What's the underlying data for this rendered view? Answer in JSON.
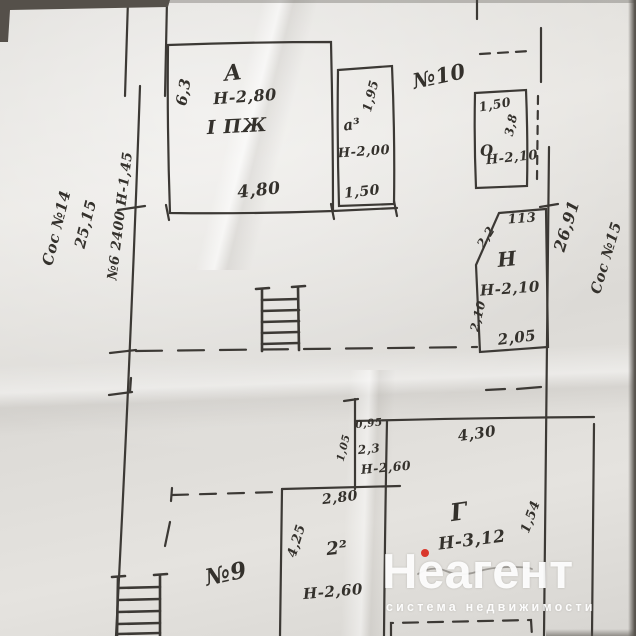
{
  "colors": {
    "paper": "#e2e0dc",
    "ink": "#3c3935",
    "watermark_accent": "#d9372b"
  },
  "plan": {
    "left_margin": {
      "neighbor_label": "Сос №14",
      "boundary_length": "25,15",
      "wall_note": "№6 2400 Н-1,45"
    },
    "right_margin": {
      "boundary_length": "26,91",
      "neighbor_label": "Сос №15"
    },
    "marks": {
      "n10": "№10",
      "n9": "№9"
    },
    "rooms": {
      "a": {
        "letter": "А",
        "side": "6,3",
        "ceiling": "Н-2,80",
        "note": "I ПЖ",
        "width": "4,80"
      },
      "a3": {
        "letter": "а³",
        "length": "1,95",
        "ceiling": "Н-2,00",
        "width": "1,50"
      },
      "o": {
        "letter": "О",
        "width": "1,50",
        "side": "3,8",
        "ceiling": "Н-2,10"
      },
      "n": {
        "letter": "Н",
        "top": "113",
        "diagonal": "2,2",
        "ceiling": "Н-2,10",
        "side": "2,10",
        "bottom": "2,05"
      },
      "g": {
        "letter": "Г",
        "width": "4,30",
        "ceiling": "Н-3,12",
        "side": "1,54"
      },
      "room2": {
        "letter": "2²",
        "width": "2,80",
        "side": "4,25",
        "ceiling": "Н-2,60"
      },
      "closet": {
        "width": "0,95",
        "side": "1,05",
        "area": "2,3",
        "ceiling": "Н-2,60"
      }
    }
  },
  "watermark": {
    "brand": "Неагент",
    "tagline": "система недвижимости"
  }
}
